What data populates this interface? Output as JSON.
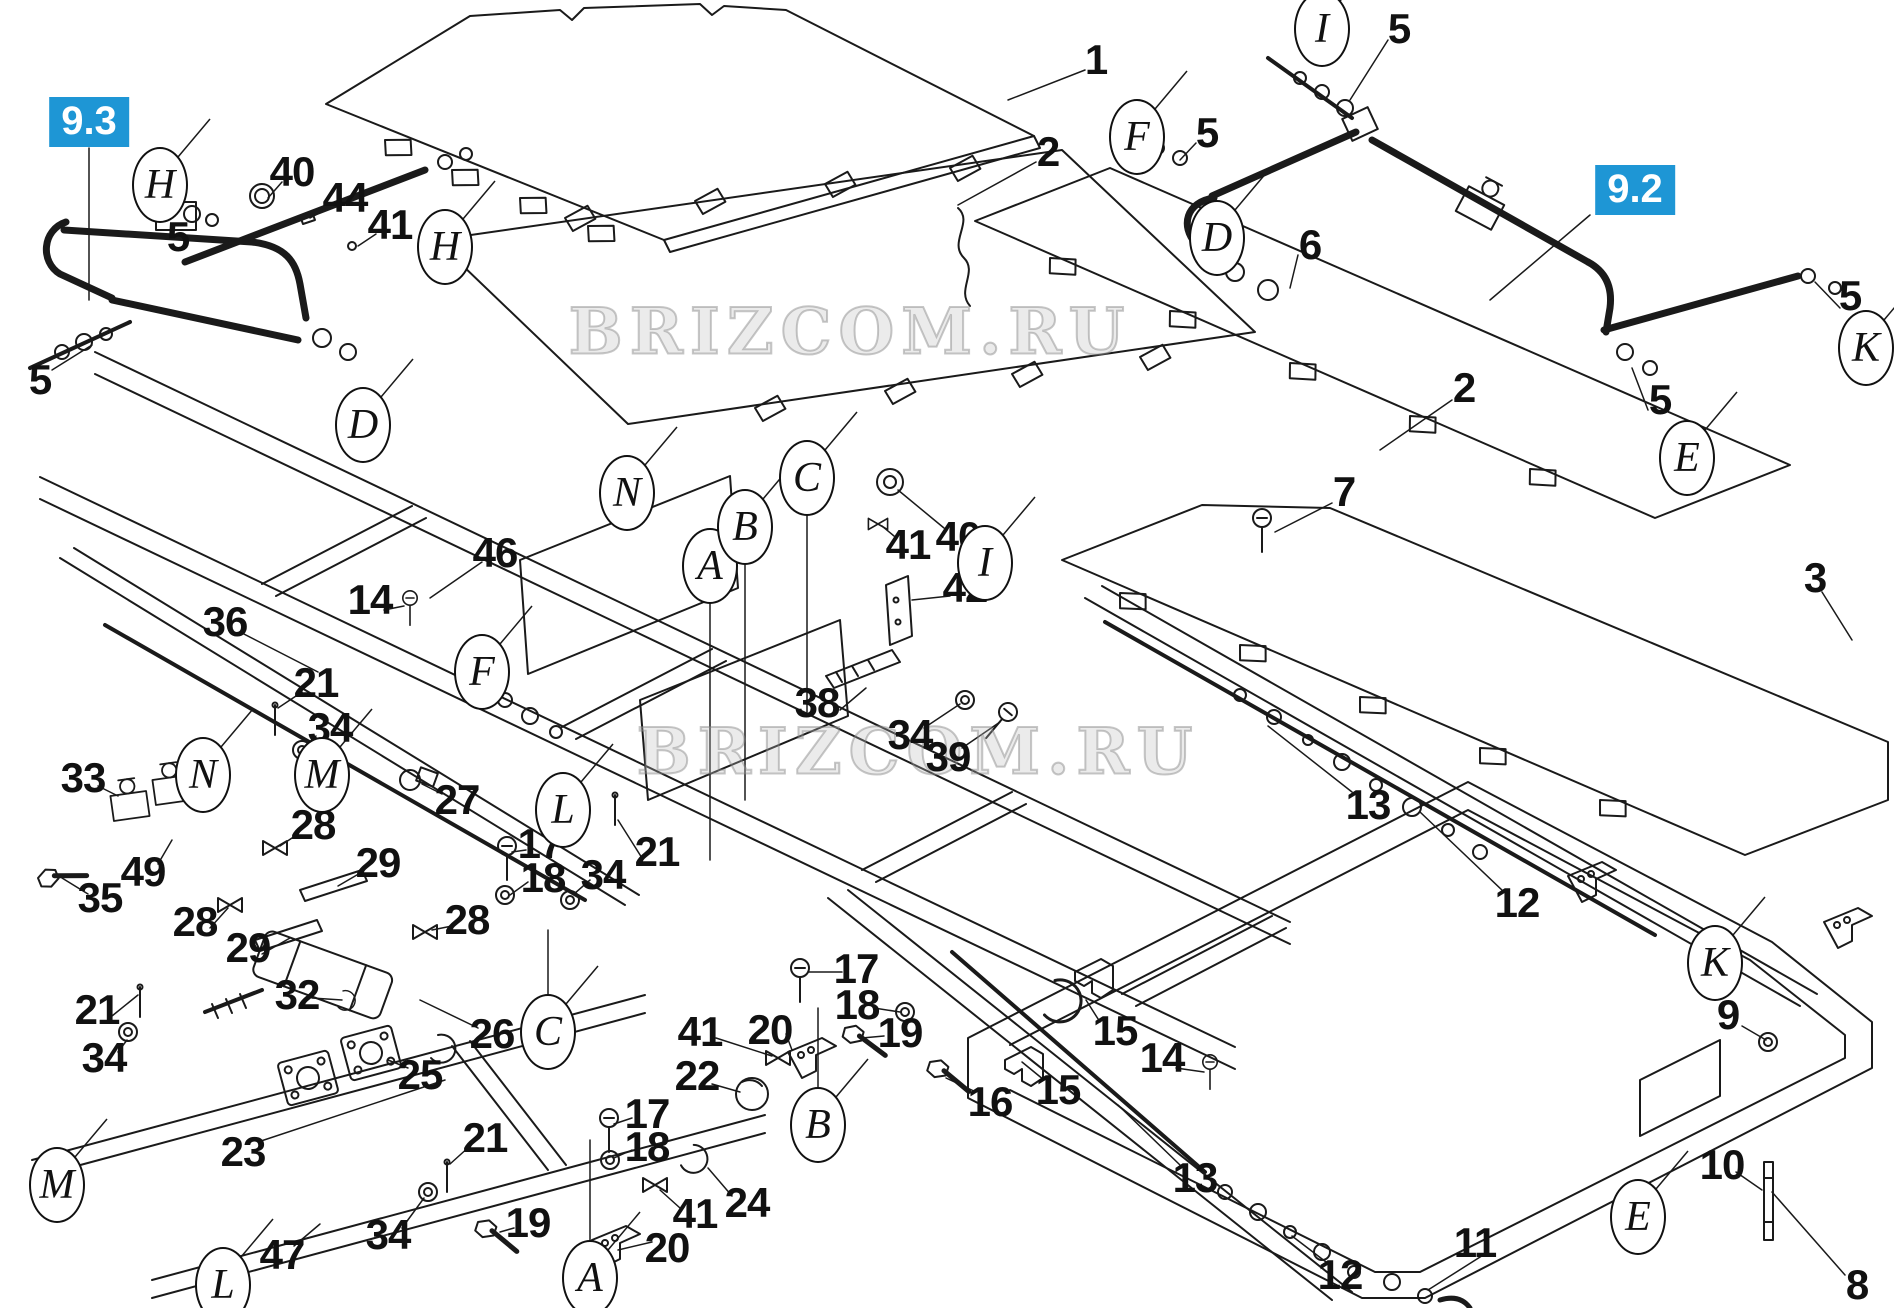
{
  "diagram": {
    "background": "#ffffff",
    "line_color": "#1a1a1a",
    "badge_color": "#1e96d5",
    "watermark": {
      "text": "BRIZCOM.RU",
      "instances": [
        {
          "x": 850,
          "y": 332
        },
        {
          "x": 918,
          "y": 752
        }
      ]
    },
    "section_badges": [
      {
        "label": "9.3",
        "x": 89,
        "y": 122
      },
      {
        "label": "9.2",
        "x": 1635,
        "y": 190
      }
    ],
    "part_numbers": [
      {
        "label": "1",
        "x": 1096,
        "y": 60
      },
      {
        "label": "2",
        "x": 1048,
        "y": 152
      },
      {
        "label": "2",
        "x": 1464,
        "y": 388
      },
      {
        "label": "3",
        "x": 1815,
        "y": 578
      },
      {
        "label": "5",
        "x": 178,
        "y": 237
      },
      {
        "label": "5",
        "x": 40,
        "y": 380
      },
      {
        "label": "5",
        "x": 1399,
        "y": 29
      },
      {
        "label": "5",
        "x": 1207,
        "y": 133
      },
      {
        "label": "5",
        "x": 1850,
        "y": 296
      },
      {
        "label": "5",
        "x": 1660,
        "y": 400
      },
      {
        "label": "6",
        "x": 1310,
        "y": 245
      },
      {
        "label": "7",
        "x": 1344,
        "y": 492
      },
      {
        "label": "8",
        "x": 1857,
        "y": 1285
      },
      {
        "label": "9",
        "x": 1728,
        "y": 1015
      },
      {
        "label": "10",
        "x": 1722,
        "y": 1165
      },
      {
        "label": "11",
        "x": 1475,
        "y": 1243
      },
      {
        "label": "12",
        "x": 1517,
        "y": 903
      },
      {
        "label": "12",
        "x": 1340,
        "y": 1275
      },
      {
        "label": "13",
        "x": 1368,
        "y": 805
      },
      {
        "label": "13",
        "x": 1195,
        "y": 1178
      },
      {
        "label": "14",
        "x": 370,
        "y": 600
      },
      {
        "label": "14",
        "x": 1162,
        "y": 1058
      },
      {
        "label": "15",
        "x": 1115,
        "y": 1031
      },
      {
        "label": "15",
        "x": 1058,
        "y": 1090
      },
      {
        "label": "16",
        "x": 990,
        "y": 1102
      },
      {
        "label": "17",
        "x": 540,
        "y": 844
      },
      {
        "label": "18",
        "x": 543,
        "y": 878
      },
      {
        "label": "17",
        "x": 856,
        "y": 969
      },
      {
        "label": "18",
        "x": 857,
        "y": 1005
      },
      {
        "label": "17",
        "x": 647,
        "y": 1114
      },
      {
        "label": "18",
        "x": 647,
        "y": 1147
      },
      {
        "label": "19",
        "x": 900,
        "y": 1033
      },
      {
        "label": "19",
        "x": 528,
        "y": 1223
      },
      {
        "label": "20",
        "x": 770,
        "y": 1030
      },
      {
        "label": "20",
        "x": 667,
        "y": 1248
      },
      {
        "label": "21",
        "x": 316,
        "y": 683
      },
      {
        "label": "21",
        "x": 657,
        "y": 852
      },
      {
        "label": "21",
        "x": 97,
        "y": 1010
      },
      {
        "label": "21",
        "x": 485,
        "y": 1138
      },
      {
        "label": "22",
        "x": 697,
        "y": 1076
      },
      {
        "label": "23",
        "x": 243,
        "y": 1152
      },
      {
        "label": "24",
        "x": 747,
        "y": 1203
      },
      {
        "label": "25",
        "x": 420,
        "y": 1075
      },
      {
        "label": "26",
        "x": 492,
        "y": 1034
      },
      {
        "label": "27",
        "x": 457,
        "y": 800
      },
      {
        "label": "28",
        "x": 313,
        "y": 825
      },
      {
        "label": "28",
        "x": 195,
        "y": 922
      },
      {
        "label": "28",
        "x": 467,
        "y": 920
      },
      {
        "label": "29",
        "x": 378,
        "y": 863
      },
      {
        "label": "29",
        "x": 248,
        "y": 948
      },
      {
        "label": "32",
        "x": 297,
        "y": 995
      },
      {
        "label": "33",
        "x": 83,
        "y": 778
      },
      {
        "label": "34",
        "x": 330,
        "y": 728
      },
      {
        "label": "34",
        "x": 603,
        "y": 875
      },
      {
        "label": "34",
        "x": 910,
        "y": 735
      },
      {
        "label": "34",
        "x": 104,
        "y": 1058
      },
      {
        "label": "34",
        "x": 388,
        "y": 1235
      },
      {
        "label": "35",
        "x": 100,
        "y": 898
      },
      {
        "label": "36",
        "x": 225,
        "y": 622
      },
      {
        "label": "38",
        "x": 817,
        "y": 703
      },
      {
        "label": "39",
        "x": 948,
        "y": 757
      },
      {
        "label": "40",
        "x": 292,
        "y": 172
      },
      {
        "label": "40",
        "x": 958,
        "y": 537
      },
      {
        "label": "41",
        "x": 390,
        "y": 225
      },
      {
        "label": "41",
        "x": 908,
        "y": 545
      },
      {
        "label": "41",
        "x": 700,
        "y": 1032
      },
      {
        "label": "41",
        "x": 695,
        "y": 1214
      },
      {
        "label": "42",
        "x": 965,
        "y": 588
      },
      {
        "label": "44",
        "x": 345,
        "y": 198
      },
      {
        "label": "46",
        "x": 495,
        "y": 553
      },
      {
        "label": "47",
        "x": 282,
        "y": 1255
      },
      {
        "label": "49",
        "x": 143,
        "y": 872
      }
    ],
    "reference_balloons": [
      {
        "label": "H",
        "x": 160,
        "y": 185
      },
      {
        "label": "H",
        "x": 445,
        "y": 247
      },
      {
        "label": "D",
        "x": 363,
        "y": 425
      },
      {
        "label": "D",
        "x": 1217,
        "y": 238
      },
      {
        "label": "F",
        "x": 482,
        "y": 672
      },
      {
        "label": "F",
        "x": 1137,
        "y": 137
      },
      {
        "label": "I",
        "x": 1322,
        "y": 29
      },
      {
        "label": "I",
        "x": 985,
        "y": 563
      },
      {
        "label": "K",
        "x": 1866,
        "y": 348
      },
      {
        "label": "K",
        "x": 1715,
        "y": 963
      },
      {
        "label": "E",
        "x": 1687,
        "y": 458
      },
      {
        "label": "E",
        "x": 1638,
        "y": 1217
      },
      {
        "label": "N",
        "x": 627,
        "y": 493
      },
      {
        "label": "N",
        "x": 203,
        "y": 775
      },
      {
        "label": "M",
        "x": 322,
        "y": 775
      },
      {
        "label": "M",
        "x": 57,
        "y": 1185
      },
      {
        "label": "L",
        "x": 563,
        "y": 810
      },
      {
        "label": "L",
        "x": 223,
        "y": 1285
      },
      {
        "label": "A",
        "x": 710,
        "y": 566
      },
      {
        "label": "A",
        "x": 590,
        "y": 1278
      },
      {
        "label": "B",
        "x": 745,
        "y": 527
      },
      {
        "label": "B",
        "x": 818,
        "y": 1125
      },
      {
        "label": "C",
        "x": 807,
        "y": 478
      },
      {
        "label": "C",
        "x": 548,
        "y": 1032
      }
    ]
  }
}
